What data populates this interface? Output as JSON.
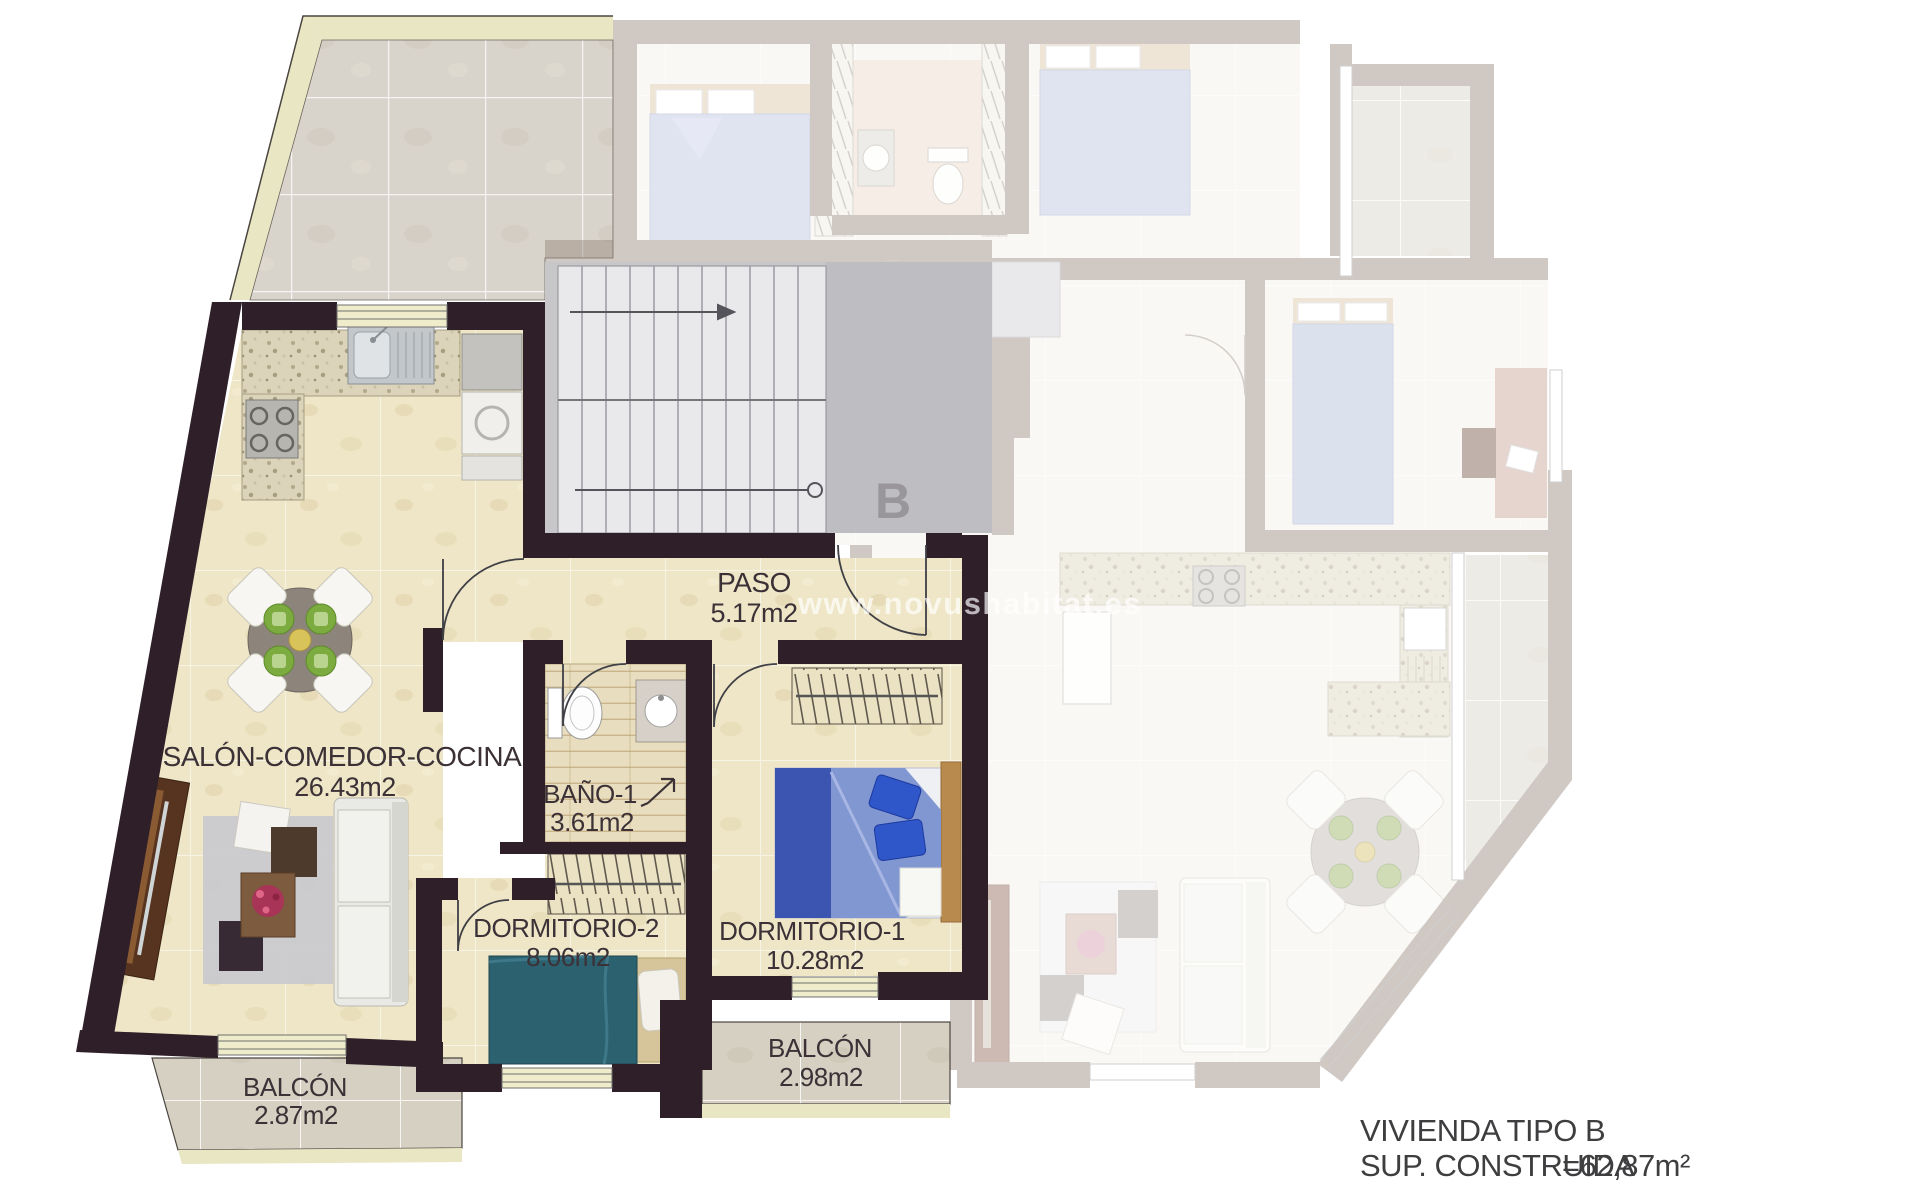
{
  "plan": {
    "building_label": "B",
    "watermark": "www.novushabitat.es",
    "rooms": {
      "paso": {
        "name": "PASO",
        "area": "5.17m2"
      },
      "salon": {
        "name": "SALÓN-COMEDOR-COCINA",
        "area": "26.43m2"
      },
      "bano1": {
        "name": "BAÑO-1",
        "area": "3.61m2"
      },
      "dormitorio2": {
        "name": "DORMITORIO-2",
        "area": "8.06m2"
      },
      "dormitorio1": {
        "name": "DORMITORIO-1",
        "area": "10.28m2"
      },
      "balcon1": {
        "name": "BALCÓN",
        "area": "2.87m2"
      },
      "balcon2": {
        "name": "BALCÓN",
        "area": "2.98m2"
      }
    },
    "title_block": {
      "line1": "VIVIENDA TIPO B",
      "line2_label": "SUP. CONSTRUIDA",
      "line2_value": "=62,87m²"
    },
    "colors": {
      "highlight_wall": "#2f1f29",
      "faded_wall": "#8f7d73",
      "floor_cream": "#eee6c6",
      "terrace_tile": "#d9d4cb",
      "stair_gray": "#c7c6c9",
      "bed_teal": "#2c6170",
      "bed_blue": "#8197d2",
      "bed_lavender": "#b7c0de",
      "label_text": "#3b3136"
    }
  }
}
